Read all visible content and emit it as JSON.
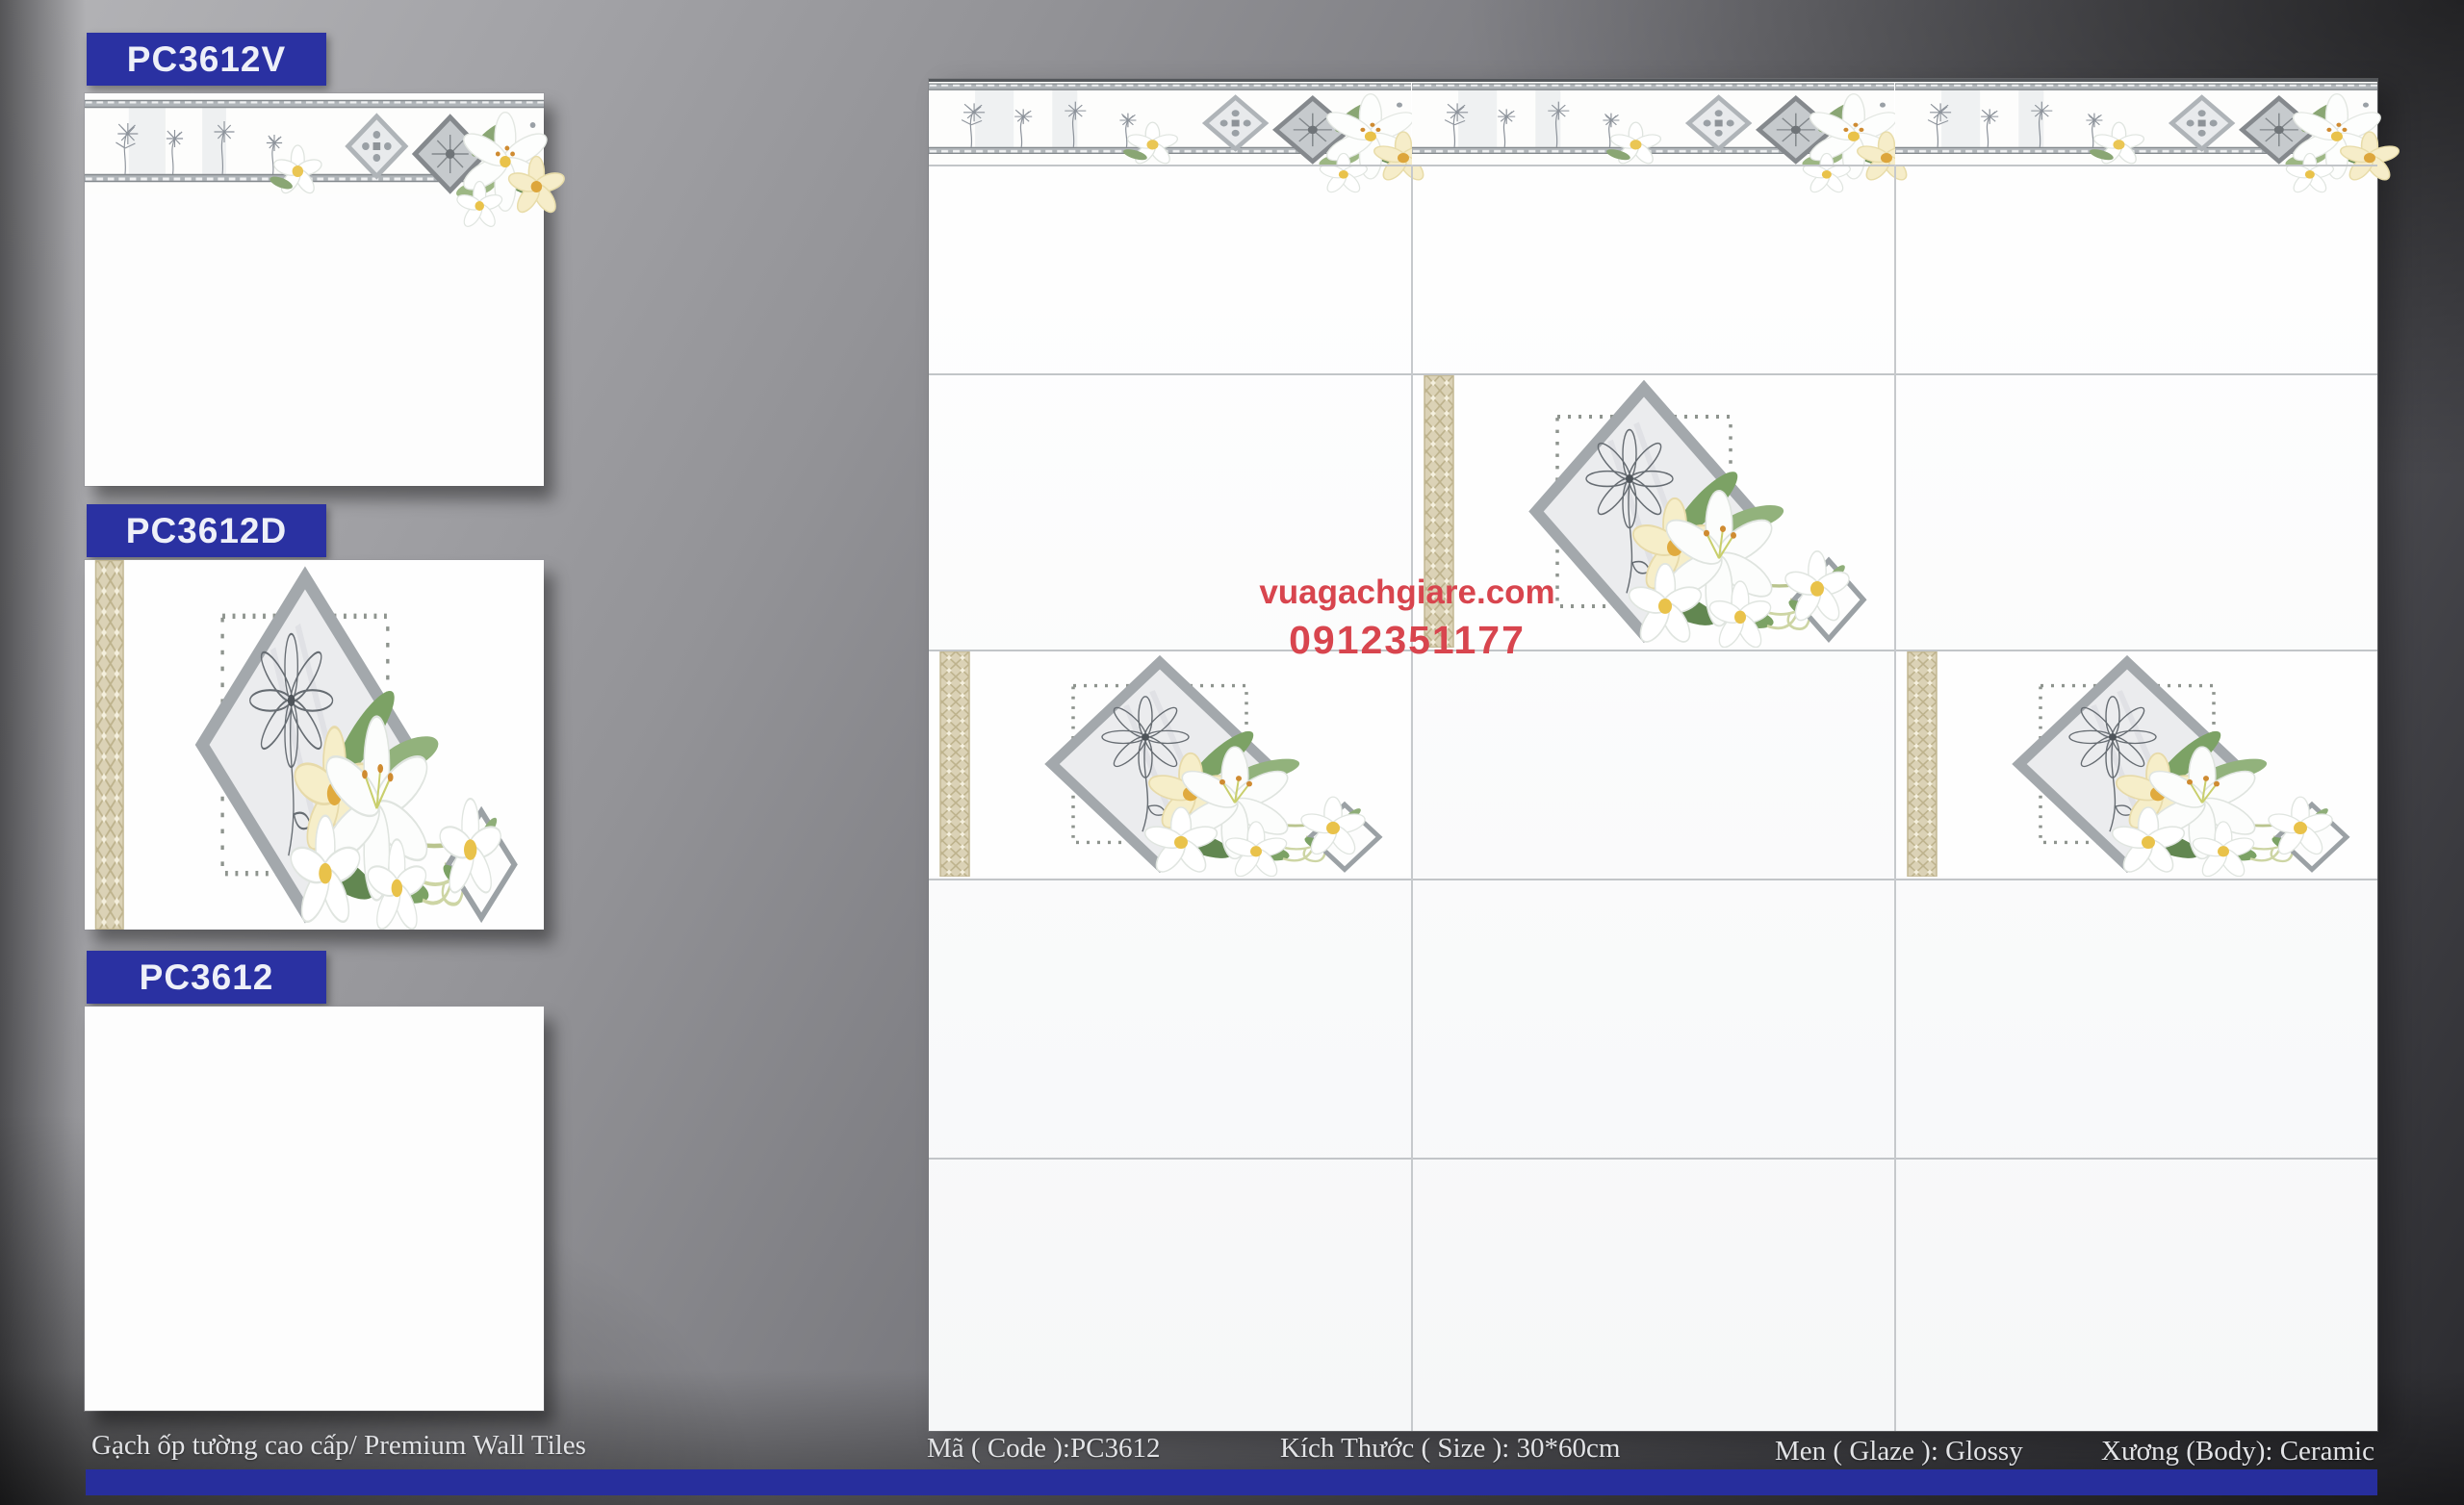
{
  "samples": [
    {
      "code": "PC3612V",
      "variant": "border-strip-tile"
    },
    {
      "code": "PC3612D",
      "variant": "decor-tile"
    },
    {
      "code": "PC3612",
      "variant": "plain-tile"
    }
  ],
  "wall": {
    "columns": 3,
    "rows": 5,
    "decor_positions": [
      "row2-col2",
      "row3-col1",
      "row3-col3"
    ],
    "border_segments": 3
  },
  "watermark": {
    "website": "vuagachgiare.com",
    "phone": "0912351177"
  },
  "footer": {
    "product": "Gạch ốp tường cao cấp/ Premium Wall Tiles",
    "code": "Mã ( Code ):PC3612",
    "size": "Kích Thước ( Size ): 30*60cm",
    "glaze": "Men ( Glaze ): Glossy",
    "body": "Xương (Body): Ceramic"
  },
  "colors": {
    "accent_blue": "#2a31a2",
    "footer_bar_blue": "#272e9d",
    "watermark_red": "#d8454e",
    "gold_band": "#dbd2b6",
    "silver_frame": "#a3a8ac"
  }
}
